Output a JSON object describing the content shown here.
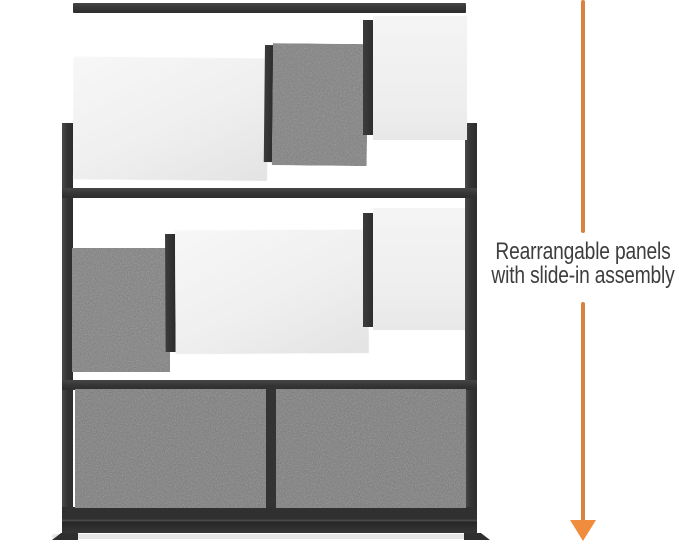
{
  "page": {
    "background": "#ffffff",
    "description": "Product feature image of a modular wall partition room divider"
  },
  "product": {
    "name": "modular-wall-partition",
    "frame_color": "#383838",
    "felt_panel_color": "#7c7c7c",
    "whiteboard_panel_color": "#f2f2f2",
    "sections": [
      {
        "position": "top",
        "state": "panels sliding in",
        "panels": [
          "whiteboard",
          "felt",
          "whiteboard"
        ]
      },
      {
        "position": "middle",
        "state": "panels sliding in",
        "panels": [
          "felt",
          "whiteboard",
          "whiteboard"
        ]
      },
      {
        "position": "bottom",
        "state": "installed",
        "panels": [
          "felt",
          "felt"
        ]
      }
    ]
  },
  "annotation": {
    "caption": {
      "line1": "Rearrangable panels",
      "line2": "with slide-in assembly"
    },
    "text_color": "#3e3e3e",
    "arrow": {
      "direction": "down",
      "line_color": "#db8240",
      "head_color": "#ef8c3e"
    }
  }
}
